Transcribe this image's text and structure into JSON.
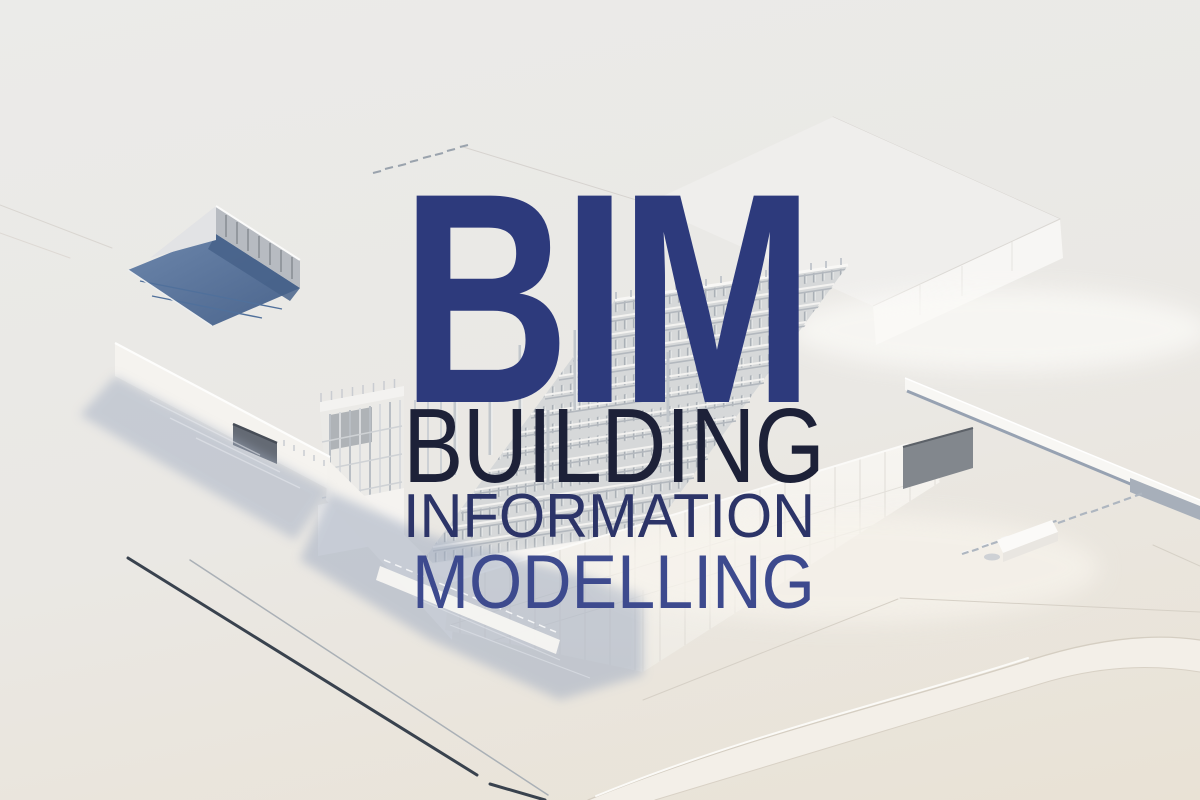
{
  "overlay": {
    "title": "BIM",
    "lines": [
      "BUILDING",
      "INFORMATION",
      "MODELLING"
    ]
  },
  "colors": {
    "title": "#2d3a7c",
    "line1": "#1d2138",
    "line2": "#2c3468",
    "line3": "#3d4a8e",
    "bg_top": "#ebebe9",
    "bg_mid": "#eae8e4",
    "bg_bottom": "#e9e2d5",
    "model_white": "#f6f4f1",
    "shadow": "#a3aec2",
    "courtyard_floor": "#5b77a0",
    "grid": "#e0ddd7",
    "road_dark": "#39424e"
  }
}
